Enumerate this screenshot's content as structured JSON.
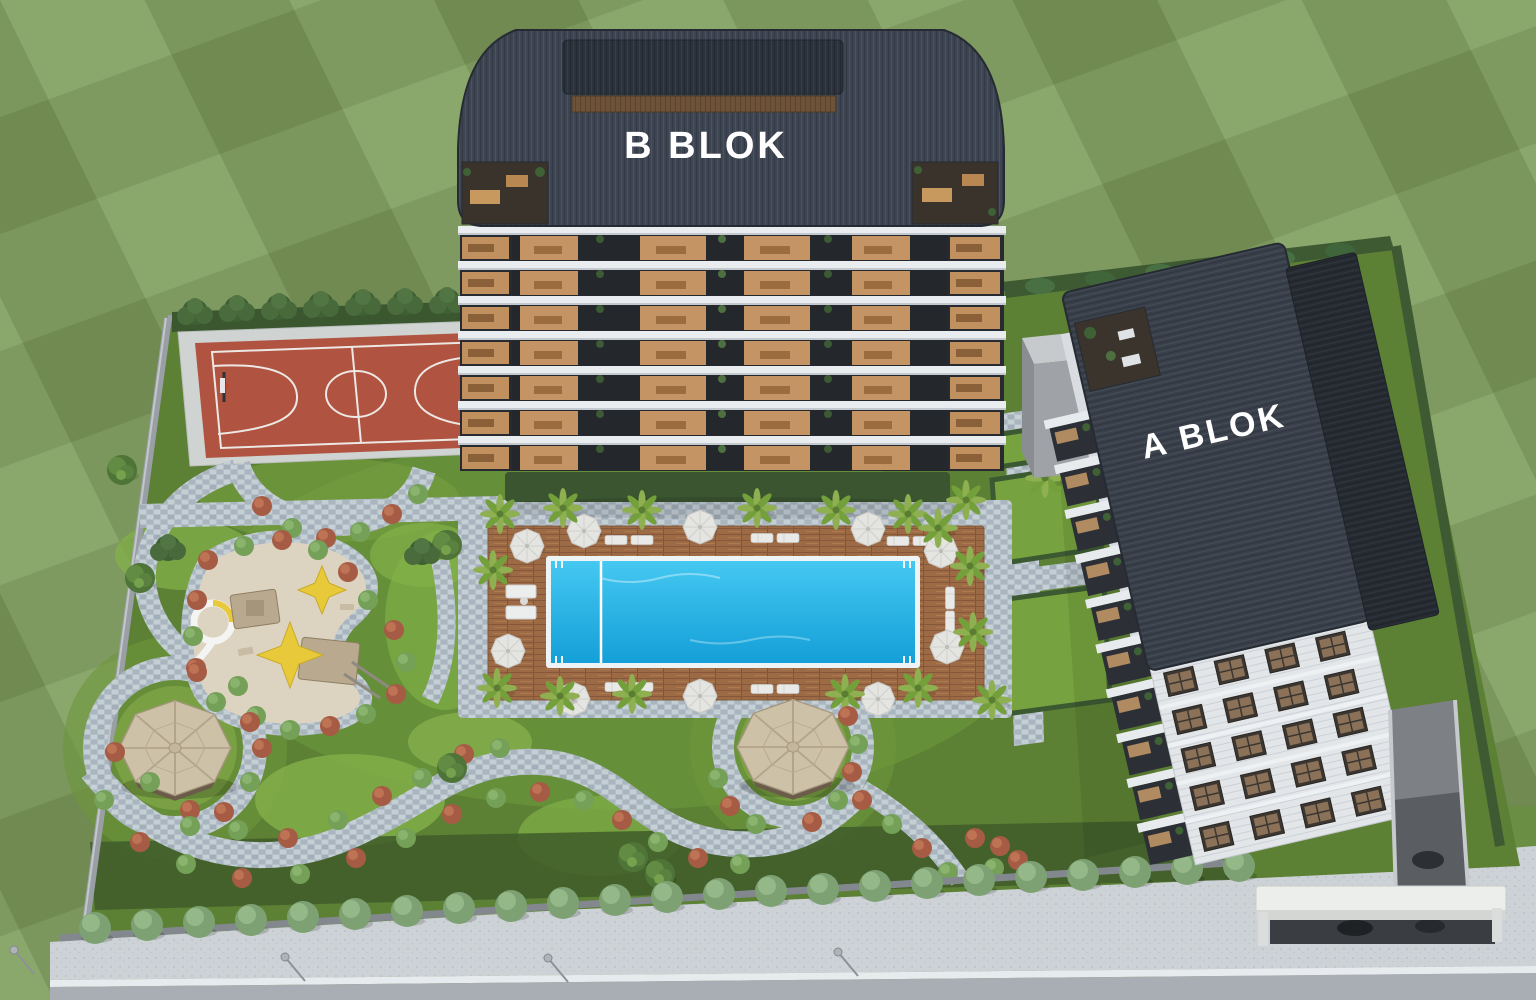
{
  "scene": {
    "type": "aerial-3d-architectural-render",
    "description": "Bird's-eye render of a gated residential complex with two apartment blocks, landscaped garden, pool, sport court and playground"
  },
  "labels": {
    "block_b": "B BLOK",
    "block_a": "A BLOK"
  },
  "palette": {
    "field_green": "#7d9a5e",
    "site_lawn": "#5c8034",
    "path_stone": "#b4bfc8",
    "pool_water": "#22b2e6",
    "deck_wood": "#9c6b45",
    "court_red": "#b05340",
    "roof_dark": "#3e4552",
    "facade_white": "#e9edf0",
    "window_warm": "#c59465",
    "bush_red": "#a65c44",
    "bush_green": "#74a058",
    "sand": "#ddd3c1",
    "boundary_wall": "#9aa0a6",
    "sidewalk": "#cdd2d7",
    "road": "#a9aeb4",
    "play_yellow": "#e7c93a"
  },
  "amenities": [
    "basketball-court",
    "swimming-pool",
    "kids-pool-section",
    "sun-deck-with-parasols",
    "children-playground",
    "gazebo-west",
    "gazebo-center",
    "walking-paths",
    "garage-ramp",
    "entrance-canopy"
  ]
}
